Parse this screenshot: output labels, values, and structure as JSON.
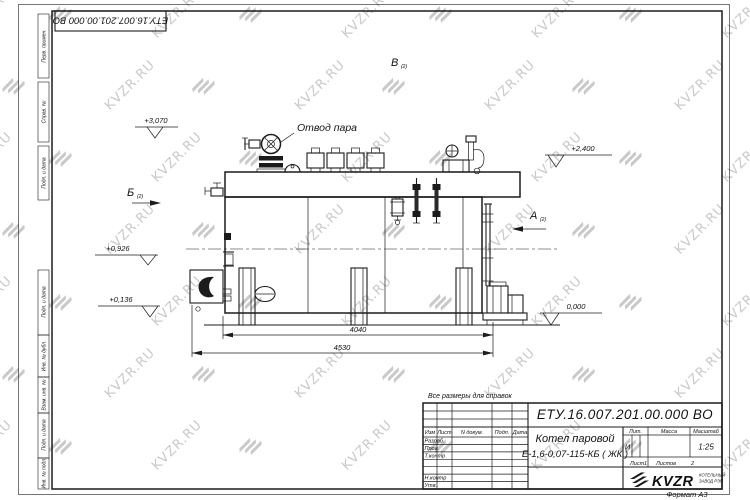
{
  "watermark": {
    "text": "KVZR.RU",
    "color": "#c9c9c9"
  },
  "sheet": {
    "doc_number": "ЕТУ.16.007.201.00.000  ВО",
    "format_note": "Формат А3",
    "reference_note": "Все размеры для справок"
  },
  "margin": {
    "cells": [
      "Перв. примен.",
      "Справ. №",
      "Подп. и дата",
      "Подп. и дата",
      "Инв. № дубл.",
      "Взам. инв. №",
      "Подп. и дата",
      "Инв. № подл."
    ]
  },
  "title_block": {
    "rev": [
      "Изм",
      "Лист",
      "N докум.",
      "Подп.",
      "Дата"
    ],
    "sig": [
      "Разраб.",
      "Пров.",
      "Т.контр",
      "Н.контр",
      "Утв."
    ],
    "product_line1": "Котел паровой",
    "product_line2": "Е-1,6-0,07-115-КБ ( ЖК )",
    "lit_header": "Лит.",
    "mass_header": "Масса",
    "scale_header": "Масштаб",
    "lit_value": "И",
    "scale_value": "1:25",
    "sheet_label": "Лист",
    "sheet_value": "1",
    "sheets_label": "Листов",
    "sheets_value": "2",
    "company": "KVZR",
    "company_sub1": "КОТЕЛЬНЫЙ",
    "company_sub2": "ЗАВОД РЭП"
  },
  "drawing": {
    "steam_callout": "Отвод пара",
    "elev_1": "+3,070",
    "elev_2": "+2,400",
    "elev_3": "+0,926",
    "elev_4": "+0,136",
    "elev_0": "0,000",
    "dim_inner": "4040",
    "dim_outer": "4530",
    "view_b": "Б",
    "view_a": "А",
    "view_v": "В",
    "view_index": "(2)"
  }
}
